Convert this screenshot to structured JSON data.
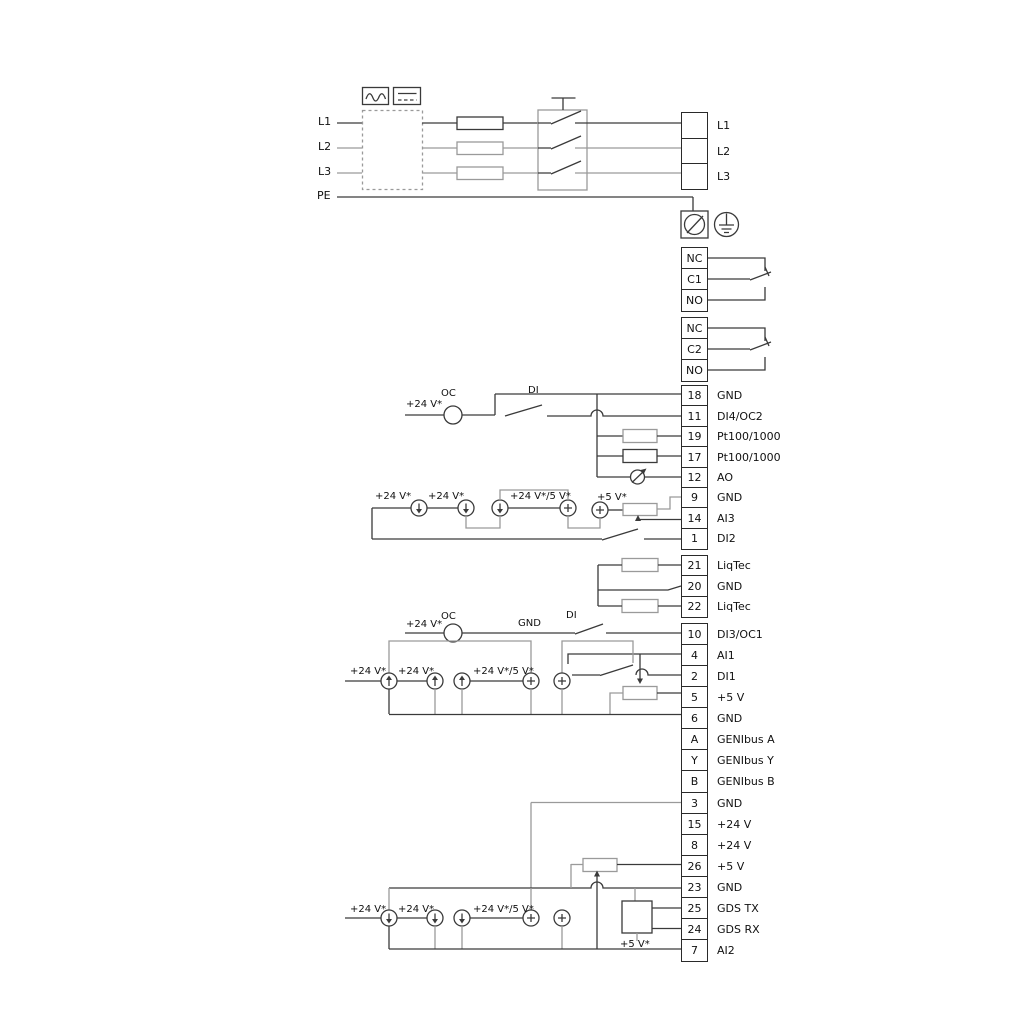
{
  "mains": {
    "left_labels": [
      "L1",
      "L2",
      "L3",
      "PE"
    ],
    "output_labels": [
      "L1",
      "L2",
      "L3"
    ]
  },
  "relays": {
    "relay1": [
      "NC",
      "C1",
      "NO"
    ],
    "relay2": [
      "NC",
      "C2",
      "NO"
    ]
  },
  "terminals": {
    "io_top": [
      {
        "no": "18",
        "label": "GND"
      },
      {
        "no": "11",
        "label": "DI4/OC2"
      },
      {
        "no": "19",
        "label": "Pt100/1000"
      },
      {
        "no": "17",
        "label": "Pt100/1000"
      },
      {
        "no": "12",
        "label": "AO"
      },
      {
        "no": "9",
        "label": "GND"
      },
      {
        "no": "14",
        "label": "AI3"
      },
      {
        "no": "1",
        "label": "DI2"
      }
    ],
    "liqtec": [
      {
        "no": "21",
        "label": "LiqTec"
      },
      {
        "no": "20",
        "label": "GND"
      },
      {
        "no": "22",
        "label": "LiqTec"
      }
    ],
    "io_mid": [
      {
        "no": "10",
        "label": "DI3/OC1"
      },
      {
        "no": "4",
        "label": "AI1"
      },
      {
        "no": "2",
        "label": "DI1"
      },
      {
        "no": "5",
        "label": "+5 V"
      },
      {
        "no": "6",
        "label": "GND"
      },
      {
        "no": "A",
        "label": "GENIbus A"
      },
      {
        "no": "Y",
        "label": "GENIbus Y"
      },
      {
        "no": "B",
        "label": "GENIbus B"
      }
    ],
    "io_bottom": [
      {
        "no": "3",
        "label": "GND"
      },
      {
        "no": "15",
        "label": "+24 V"
      },
      {
        "no": "8",
        "label": "+24 V"
      },
      {
        "no": "26",
        "label": "+5 V"
      },
      {
        "no": "23",
        "label": "GND"
      },
      {
        "no": "25",
        "label": "GDS TX"
      },
      {
        "no": "24",
        "label": "GDS RX"
      },
      {
        "no": "7",
        "label": "AI2"
      }
    ]
  },
  "annotations": [
    {
      "text": "+24 V*"
    },
    {
      "text": "OC"
    },
    {
      "text": "DI"
    },
    {
      "text": "+24 V*"
    },
    {
      "text": "+24 V*"
    },
    {
      "text": "+24 V*/5 V*"
    },
    {
      "text": "+5 V*"
    },
    {
      "text": "+24 V*"
    },
    {
      "text": "OC"
    },
    {
      "text": "GND"
    },
    {
      "text": "DI"
    },
    {
      "text": "+24 V*"
    },
    {
      "text": "+24 V*"
    },
    {
      "text": "+24 V*/5 V*"
    },
    {
      "text": "+24 V*"
    },
    {
      "text": "+24 V*"
    },
    {
      "text": "+24 V*/5 V*"
    },
    {
      "text": "+5 V*"
    }
  ],
  "colors": {
    "wire": "#3a3a3a",
    "wire_secondary": "#9a9a9a",
    "text": "#111111"
  }
}
